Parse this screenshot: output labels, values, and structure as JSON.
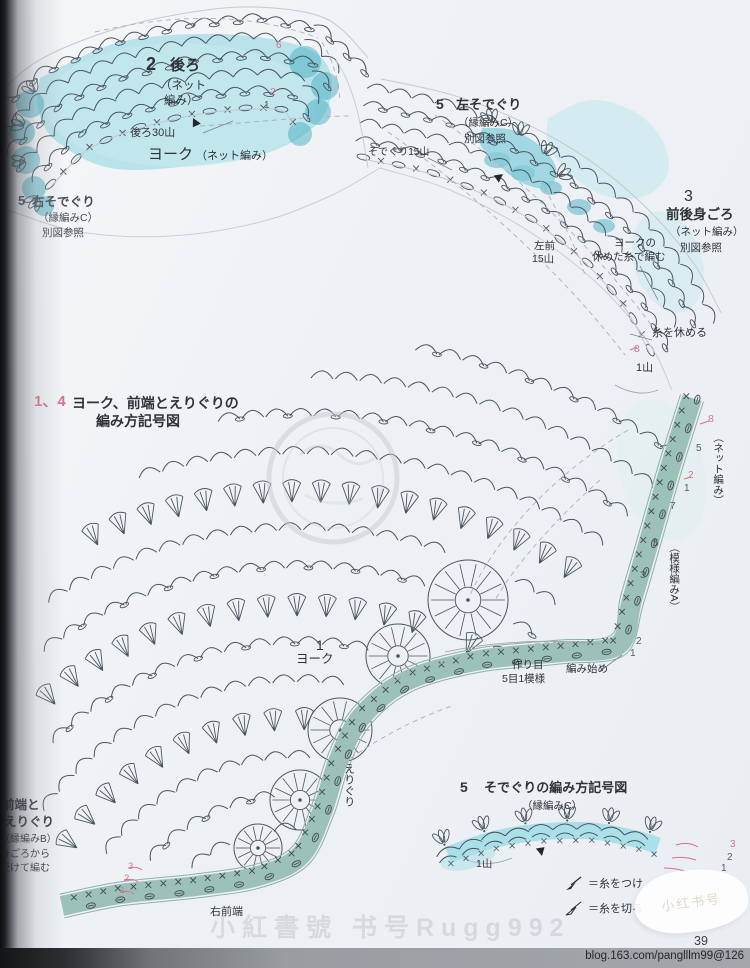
{
  "colors": {
    "page_bg": "#eef0f4",
    "line": "#4a5560",
    "teal_light": "#a6dce6",
    "teal_mid": "#7fccda",
    "teal_dark": "#46aec2",
    "teal_pale": "#cdeaf0",
    "sage": "#9cc1b9",
    "aqua": "#a8dee8",
    "pink": "#d4738f",
    "text": "#2e3338",
    "footer_band": "#989da2"
  },
  "pieces": {
    "p2": {
      "num": "2",
      "name": "後ろ",
      "sub1": "（ネット",
      "sub2": "編み）"
    },
    "p3": {
      "num": "3",
      "name": "前後身ごろ",
      "sub": "（ネット編み）",
      "ref": "別図参照"
    },
    "p5L": {
      "num": "5",
      "name": "左そでぐり",
      "sub": "（縁編みC）",
      "ref": "別図参照"
    },
    "p5R": {
      "num": "5",
      "name": "右そでぐり",
      "sub": "（縁編みC）",
      "ref": "別図参照"
    },
    "p14": {
      "num": "1、4",
      "title1": "ヨーク、前端とえりぐりの",
      "title2": "編み方記号図"
    },
    "p1": {
      "num": "1",
      "name": "ヨーク"
    },
    "p4": {
      "lines": [
        "前端と",
        "えりぐり",
        "（縁編みB）",
        "身ごろから",
        "続けて編む"
      ]
    },
    "p5d": {
      "num": "5",
      "title": "そでぐりの編み方記号図",
      "sub": "（縁編みC）"
    }
  },
  "labels": {
    "back30": "後ろ30山",
    "yoke": "ヨーク",
    "yoke_sub": "（ネット編み）",
    "armhole15": "そでぐり15山",
    "front_left": "左前",
    "front_left2": "15山",
    "yoke_rest1": "ヨークの",
    "yoke_rest2": "休めた糸で編む",
    "rest_yarn": "糸を休める",
    "one_yama": "1山",
    "net": "（ネット編み）",
    "patternA": "（模様編みA）",
    "foundation1": "作り目",
    "foundation2": "5目1模様",
    "start": "編み始め",
    "neck": "えりぐり",
    "right_front": "右前端",
    "mini_one_yama": "1山"
  },
  "annotations": {
    "back_rows": [
      "6",
      "2",
      "1"
    ],
    "rest8": "8",
    "net_rows": [
      "8",
      "5",
      "2",
      "1"
    ],
    "pattern_rows": [
      "7",
      "5",
      "3"
    ],
    "start_rows": [
      "2",
      "1"
    ],
    "left_rows": [
      "3",
      "2",
      "1"
    ],
    "mini_rows": [
      "3",
      "2",
      "1"
    ]
  },
  "legend": {
    "attach": "＝糸をつけ",
    "cut": "＝糸を切る"
  },
  "footer": {
    "page": "39",
    "url": "blog.163.com/panglllm99@126",
    "watermark": "小紅書號 书号Rugg992",
    "sticker": "小红书号"
  }
}
